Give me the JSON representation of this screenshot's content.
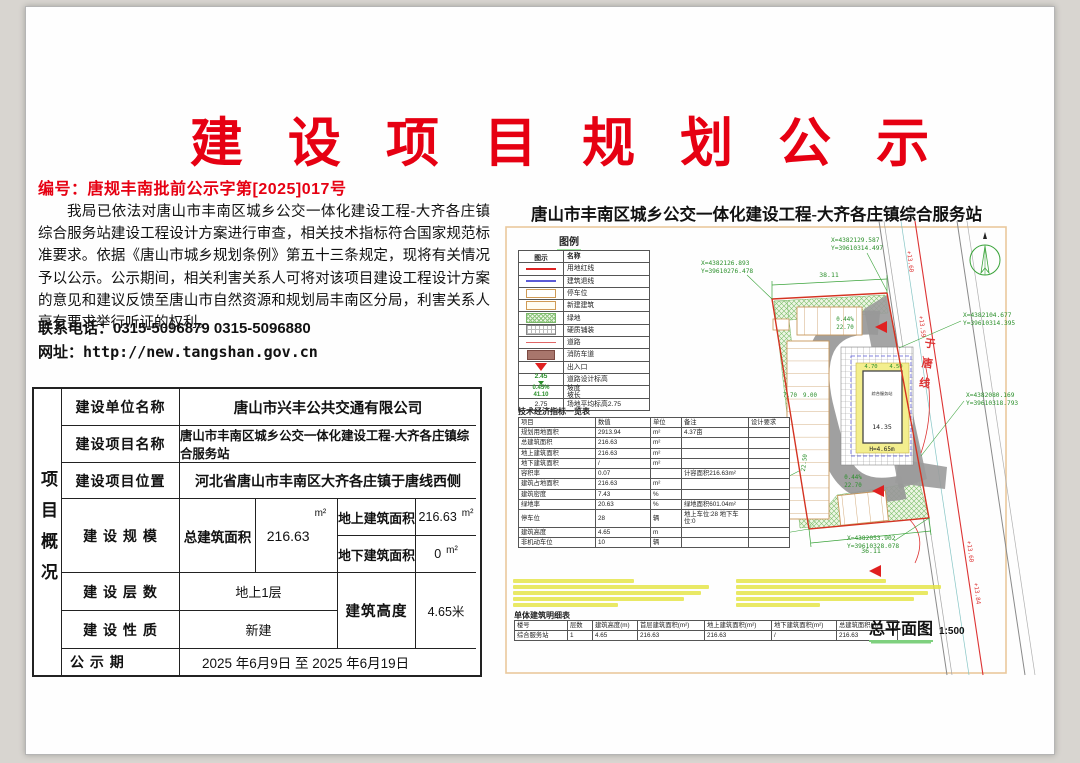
{
  "notice": {
    "title": "建 设 项 目 规 划 公 示",
    "doc_no": "编号：唐规丰南批前公示字第[2025]017号",
    "paragraph": "我局已依法对唐山市丰南区城乡公交一体化建设工程-大齐各庄镇综合服务站建设工程设计方案进行审查，相关技术指标符合国家规范标准要求。依据《唐山市城乡规划条例》第五十三条规定，现将有关情况予以公示。公示期间，相关利害关系人可将对该项目建设工程设计方案的意见和建议反馈至唐山市自然资源和规划局丰南区分局，利害关系人享有要求举行听证的权利。",
    "phone": "联系电话：0315-5096879 0315-5096880",
    "website": "网址：http://new.tangshan.gov.cn"
  },
  "summary": {
    "side_label": "项目概况",
    "unit_label": "建设单位名称",
    "unit_value": "唐山市兴丰公共交通有限公司",
    "project_label": "建设项目名称",
    "project_value": "唐山市丰南区城乡公交一体化建设工程-大齐各庄镇综合服务站",
    "location_label": "建设项目位置",
    "location_value": "河北省唐山市丰南区大齐各庄镇于唐线西侧",
    "scale_label": "建 设 规 模",
    "total_label": "总建筑面积",
    "total_value": "216.63",
    "total_unit": "m²",
    "above_label": "地上建筑面积",
    "above_value": "216.63",
    "above_unit": "m²",
    "below_label": "地下建筑面积",
    "below_value": "0",
    "below_unit": "m²",
    "floors_label": "建 设 层 数",
    "floors_value": "地上1层",
    "nature_label": "建 设 性 质",
    "nature_value": "新建",
    "height_label": "建筑高度",
    "height_value": "4.65米",
    "period_label": "公 示 期",
    "period_value": "2025 年6月9日 至 2025 年6月19日"
  },
  "site_plan": {
    "title": "唐山市丰南区城乡公交一体化建设工程-大齐各庄镇综合服务站",
    "legend": {
      "title": "图例",
      "col_symbol": "图示",
      "col_name": "名称",
      "items": [
        {
          "name": "用地红线"
        },
        {
          "name": "建筑退线"
        },
        {
          "name": "停车位"
        },
        {
          "name": "新建建筑"
        },
        {
          "name": "绿地"
        },
        {
          "name": "硬质铺装"
        },
        {
          "name": "道路"
        },
        {
          "name": "消防车道"
        },
        {
          "name": "出入口"
        },
        {
          "name": "道路设计标高",
          "symbol_text": "2.45"
        },
        {
          "name": "坡度\n坡长",
          "symbol_text": "0.45%\n41.10"
        },
        {
          "name": "场地平均标高2.75",
          "symbol_text": "2.75"
        }
      ]
    },
    "tech_table": {
      "title": "技术经济指标一览表",
      "headers": [
        "项目",
        "数值",
        "单位",
        "备注",
        "设计要求"
      ],
      "rows": [
        [
          "规划用地面积",
          "2913.94",
          "m²",
          "4.37亩",
          ""
        ],
        [
          "总建筑面积",
          "216.63",
          "m²",
          "",
          ""
        ],
        [
          "地上建筑面积",
          "216.63",
          "m²",
          "",
          ""
        ],
        [
          "地下建筑面积",
          "/",
          "m²",
          "",
          ""
        ],
        [
          "容积率",
          "0.07",
          "",
          "计容面积216.63m²",
          ""
        ],
        [
          "建筑占地面积",
          "216.63",
          "m²",
          "",
          ""
        ],
        [
          "建筑密度",
          "7.43",
          "%",
          "",
          ""
        ],
        [
          "绿地率",
          "20.63",
          "%",
          "绿地面积601.04m²",
          ""
        ],
        [
          "停车位",
          "28",
          "辆",
          "地上车位:28 地下车位:0",
          ""
        ],
        [
          "建筑高度",
          "4.65",
          "m",
          "",
          ""
        ],
        [
          "非机动车位",
          "10",
          "辆",
          "",
          ""
        ]
      ]
    },
    "building_table": {
      "title": "单体建筑明细表",
      "headers": [
        "楼号",
        "层数",
        "建筑高度(m)",
        "首层建筑面积(m²)",
        "地上建筑面积(m²)",
        "地下建筑面积(m²)",
        "总建筑面积(m²)"
      ],
      "rows": [
        [
          "综合服务站",
          "1",
          "4.65",
          "216.63",
          "216.63",
          "/",
          "216.63"
        ]
      ]
    },
    "plan_label": "总平面图",
    "plan_scale": "1:500",
    "plan": {
      "road_name": "于唐线",
      "building_name": "综合服务站",
      "dims": {
        "top": "38.11",
        "bottom": "36.11",
        "slope_pct": "0.44%",
        "slope_len": "22.70",
        "stall_a": "7.70",
        "stall_b": "9.00",
        "side": "22.50",
        "bld_w1": "4.70",
        "bld_w2": "4.50",
        "bld_len": "14.35",
        "bld_h": "H=4.65m"
      },
      "elevations": [
        "+13.60",
        "+13.59",
        "+13.60",
        "+13.84"
      ],
      "coords": [
        {
          "x": "X=4382129.587",
          "y": "Y=39610314.497"
        },
        {
          "x": "X=4382126.893",
          "y": "Y=39610276.478"
        },
        {
          "x": "X=4382104.677",
          "y": "Y=39610314.395"
        },
        {
          "x": "X=4382080.169",
          "y": "Y=39610318.793"
        },
        {
          "x": "X=4382078.632",
          "y": "Y=39610310.230"
        },
        {
          "x": "X=4382051.208",
          "y": "Y=39610290.062"
        },
        {
          "x": "X=4382053.902",
          "y": "Y=39610328.078"
        }
      ]
    }
  }
}
